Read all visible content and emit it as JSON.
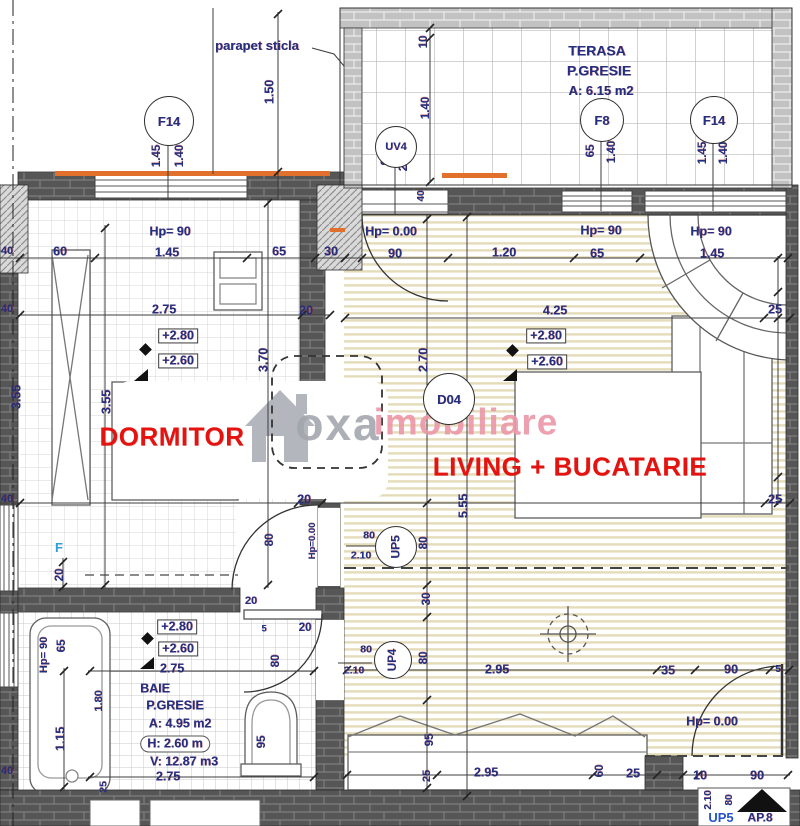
{
  "plan_info": {
    "apartment_tag": "AP.8",
    "rooms": [
      {
        "name": "DORMITOR"
      },
      {
        "name": "LIVING + BUCATARIE"
      },
      {
        "name": "TERASA",
        "finish": "P.GRESIE",
        "area": "A: 6.15 m2"
      },
      {
        "name": "BAIE",
        "finish": "P.GRESIE",
        "area": "A: 4.95 m2",
        "height": "H: 2.60 m",
        "volume": "V: 12.87 m3"
      }
    ],
    "window_door_tags": [
      "F14",
      "UV4",
      "F8",
      "F14",
      "D04",
      "UP5",
      "UP4",
      "F"
    ],
    "note": "parapet sticla",
    "levels": [
      "+2.80",
      "+2.60",
      "Hp= 90",
      "Hp= 0.00"
    ]
  },
  "colors": {
    "dim_navy": "#232e7f",
    "room_red": "#e51310",
    "orange_parapet": "#e0702c",
    "wall_dark": "#565656",
    "wall_light": "#c3c3c3",
    "watermark_gray": "#a0a5ac",
    "watermark_pink": "#ec98a8",
    "window_blue": "#2d9fd8"
  },
  "watermark": {
    "brand_gray": "oxa",
    "brand_pink": "imobiliare",
    "icon": "house-icon"
  },
  "circles": [
    {
      "t": "F14",
      "x": 168,
      "y": 120,
      "rad": 24,
      "s": 13
    },
    {
      "t": "UV4",
      "x": 395,
      "y": 146,
      "rad": 20,
      "s": 11
    },
    {
      "t": "F8",
      "x": 601,
      "y": 119,
      "rad": 21,
      "s": 13
    },
    {
      "t": "F14",
      "x": 713,
      "y": 119,
      "rad": 23,
      "s": 13
    },
    {
      "t": "D04",
      "x": 448,
      "y": 398,
      "rad": 25,
      "s": 13
    },
    {
      "t": "UP5",
      "x": 395,
      "y": 546,
      "rad": 20,
      "s": 12,
      "rot": -90
    },
    {
      "t": "UP4",
      "x": 392,
      "y": 659,
      "rad": 18,
      "s": 11.5,
      "rot": -90
    }
  ],
  "labels": [
    {
      "t": "parapet sticla",
      "x": 257,
      "y": 46,
      "s": 13
    },
    {
      "t": "TERASA",
      "x": 597,
      "y": 51,
      "s": 14
    },
    {
      "t": "P.GRESIE",
      "x": 599,
      "y": 71,
      "s": 14
    },
    {
      "t": "A: 6.15 m2",
      "x": 601,
      "y": 91,
      "s": 13
    },
    {
      "t": "1.50",
      "x": 270,
      "y": 92,
      "r": -90
    },
    {
      "t": "1.45",
      "x": 157,
      "y": 156,
      "r": -90,
      "s": 11.5
    },
    {
      "t": "1.40",
      "x": 180,
      "y": 156,
      "r": -90,
      "s": 11.5
    },
    {
      "t": "10",
      "x": 424,
      "y": 42,
      "r": -90,
      "s": 11.5
    },
    {
      "t": "1.40",
      "x": 426,
      "y": 108,
      "r": -90,
      "s": 11.5
    },
    {
      "t": "90",
      "x": 386,
      "y": 159,
      "r": -90,
      "s": 11.5
    },
    {
      "t": "2.10",
      "x": 404,
      "y": 160,
      "r": -90,
      "s": 11.5
    },
    {
      "t": "65",
      "x": 591,
      "y": 151,
      "r": -90,
      "s": 11.5
    },
    {
      "t": "1.40",
      "x": 612,
      "y": 152,
      "r": -90,
      "s": 11.5
    },
    {
      "t": "1.45",
      "x": 703,
      "y": 153,
      "r": -90,
      "s": 11.5
    },
    {
      "t": "1.40",
      "x": 724,
      "y": 153,
      "r": -90,
      "s": 11.5
    },
    {
      "t": "40",
      "x": 422,
      "y": 196,
      "r": -90,
      "s": 10
    },
    {
      "t": "Hp= 90",
      "x": 170,
      "y": 232,
      "s": 12.5
    },
    {
      "t": "1.45",
      "x": 167,
      "y": 253
    },
    {
      "t": "40",
      "x": 7,
      "y": 252,
      "s": 11
    },
    {
      "t": "60",
      "x": 60,
      "y": 252
    },
    {
      "t": "65",
      "x": 279,
      "y": 252
    },
    {
      "t": "30",
      "x": 331,
      "y": 252
    },
    {
      "t": "Hp= 0.00",
      "x": 391,
      "y": 232,
      "s": 12.5
    },
    {
      "t": "90",
      "x": 395,
      "y": 254
    },
    {
      "t": "1.20",
      "x": 504,
      "y": 253
    },
    {
      "t": "Hp= 90",
      "x": 601,
      "y": 231,
      "s": 12.5
    },
    {
      "t": "65",
      "x": 597,
      "y": 254
    },
    {
      "t": "Hp= 90",
      "x": 711,
      "y": 232,
      "s": 12.5
    },
    {
      "t": "1.45",
      "x": 712,
      "y": 254
    },
    {
      "t": "2.75",
      "x": 164,
      "y": 310
    },
    {
      "t": "20",
      "x": 306,
      "y": 311
    },
    {
      "t": "4.25",
      "x": 555,
      "y": 311
    },
    {
      "t": "25",
      "x": 775,
      "y": 310
    },
    {
      "t": "+2.80",
      "x": 178,
      "y": 336,
      "k": "box"
    },
    {
      "t": "+2.60",
      "x": 178,
      "y": 361,
      "k": "box"
    },
    {
      "t": "+2.80",
      "x": 546,
      "y": 336,
      "k": "box"
    },
    {
      "t": "+2.60",
      "x": 547,
      "y": 362,
      "k": "box"
    },
    {
      "t": "3.55",
      "x": 17,
      "y": 397,
      "r": -90
    },
    {
      "t": "3.55",
      "x": 107,
      "y": 402,
      "r": -90
    },
    {
      "t": "3.70",
      "x": 264,
      "y": 360,
      "r": -90
    },
    {
      "t": "2.70",
      "x": 424,
      "y": 360,
      "r": -90
    },
    {
      "t": "DORMITOR",
      "x": 172,
      "y": 437,
      "k": "red",
      "s": 26
    },
    {
      "t": "LIVING + BUCATARIE",
      "x": 570,
      "y": 467,
      "k": "red",
      "s": 26
    },
    {
      "t": "F",
      "x": 59,
      "y": 548,
      "k": "blue",
      "s": 13
    },
    {
      "t": "20",
      "x": 60,
      "y": 575,
      "r": -90,
      "s": 11.5
    },
    {
      "t": "80",
      "x": 270,
      "y": 540,
      "r": -90,
      "s": 11.5
    },
    {
      "t": "Hp=0.00",
      "x": 313,
      "y": 541,
      "r": -90,
      "s": 9.5
    },
    {
      "t": "20",
      "x": 304,
      "y": 500
    },
    {
      "t": "25",
      "x": 775,
      "y": 500
    },
    {
      "t": "5.55",
      "x": 464,
      "y": 506,
      "r": -90
    },
    {
      "t": "80",
      "x": 424,
      "y": 543,
      "r": -90,
      "s": 11.5
    },
    {
      "t": "80",
      "x": 369,
      "y": 536,
      "s": 10.5
    },
    {
      "t": "2.10",
      "x": 361,
      "y": 556,
      "s": 10.5
    },
    {
      "t": "30",
      "x": 427,
      "y": 599,
      "r": -90,
      "s": 11.5
    },
    {
      "t": "80",
      "x": 366,
      "y": 650,
      "s": 10.5
    },
    {
      "t": "2.10",
      "x": 354,
      "y": 671,
      "s": 10.5
    },
    {
      "t": "80",
      "x": 424,
      "y": 658,
      "r": -90,
      "s": 11.5
    },
    {
      "t": "20",
      "x": 251,
      "y": 602,
      "s": 11
    },
    {
      "t": "20",
      "x": 305,
      "y": 628,
      "s": 11.5
    },
    {
      "t": "5",
      "x": 264,
      "y": 629,
      "s": 9
    },
    {
      "t": "+2.80",
      "x": 177,
      "y": 627,
      "k": "box"
    },
    {
      "t": "+2.60",
      "x": 178,
      "y": 649,
      "k": "box"
    },
    {
      "t": "2.75",
      "x": 172,
      "y": 669
    },
    {
      "t": "BAIE",
      "x": 155,
      "y": 689,
      "s": 12.5
    },
    {
      "t": "P.GRESIE",
      "x": 175,
      "y": 706,
      "s": 12.5
    },
    {
      "t": "A: 4.95 m2",
      "x": 180,
      "y": 724,
      "s": 12.5
    },
    {
      "t": "H: 2.60 m",
      "x": 175,
      "y": 744,
      "s": 12.5,
      "k": "rbox"
    },
    {
      "t": "V: 12.87 m3",
      "x": 184,
      "y": 762,
      "s": 12.5
    },
    {
      "t": "2.75",
      "x": 168,
      "y": 777
    },
    {
      "t": "Hp= 90",
      "x": 45,
      "y": 655,
      "r": -90,
      "s": 11
    },
    {
      "t": "65",
      "x": 62,
      "y": 646,
      "r": -90,
      "s": 11.5
    },
    {
      "t": "1.15",
      "x": 61,
      "y": 739,
      "r": -90
    },
    {
      "t": "1.80",
      "x": 100,
      "y": 701,
      "r": -90,
      "s": 11
    },
    {
      "t": "80",
      "x": 276,
      "y": 661,
      "r": -90,
      "s": 11.5
    },
    {
      "t": "95",
      "x": 262,
      "y": 742,
      "r": -90,
      "s": 11.5
    },
    {
      "t": "95",
      "x": 430,
      "y": 740,
      "r": -90,
      "s": 11.5
    },
    {
      "t": "25",
      "x": 428,
      "y": 776,
      "r": -90,
      "s": 11
    },
    {
      "t": "25",
      "x": 104,
      "y": 787,
      "r": -90,
      "s": 10.5
    },
    {
      "t": "2.95",
      "x": 497,
      "y": 670
    },
    {
      "t": "35",
      "x": 668,
      "y": 671
    },
    {
      "t": "90",
      "x": 731,
      "y": 670
    },
    {
      "t": "5",
      "x": 778,
      "y": 670,
      "s": 10
    },
    {
      "t": "Hp= 0.00",
      "x": 712,
      "y": 722,
      "s": 12.5
    },
    {
      "t": "2.95",
      "x": 486,
      "y": 773
    },
    {
      "t": "60",
      "x": 600,
      "y": 771,
      "r": -90,
      "s": 11.5
    },
    {
      "t": "25",
      "x": 633,
      "y": 774
    },
    {
      "t": "10",
      "x": 700,
      "y": 776
    },
    {
      "t": "90",
      "x": 757,
      "y": 776
    },
    {
      "t": "2.10",
      "x": 709,
      "y": 800,
      "r": -90,
      "s": 10
    },
    {
      "t": "80",
      "x": 730,
      "y": 800,
      "r": -90,
      "s": 10
    },
    {
      "t": "UP5",
      "x": 721,
      "y": 818,
      "k": "blue2",
      "s": 13
    },
    {
      "t": "AP.8",
      "x": 760,
      "y": 818,
      "s": 12
    },
    {
      "t": "40",
      "x": 7,
      "y": 310,
      "s": 11
    },
    {
      "t": "40",
      "x": 7,
      "y": 500,
      "s": 11
    },
    {
      "t": "40",
      "x": 7,
      "y": 772,
      "s": 11
    },
    {
      "t": "oxa",
      "x": 338,
      "y": 424,
      "k": "wmg",
      "s": 46
    },
    {
      "t": "imobiliare",
      "x": 466,
      "y": 423,
      "k": "wmp",
      "s": 37
    }
  ]
}
